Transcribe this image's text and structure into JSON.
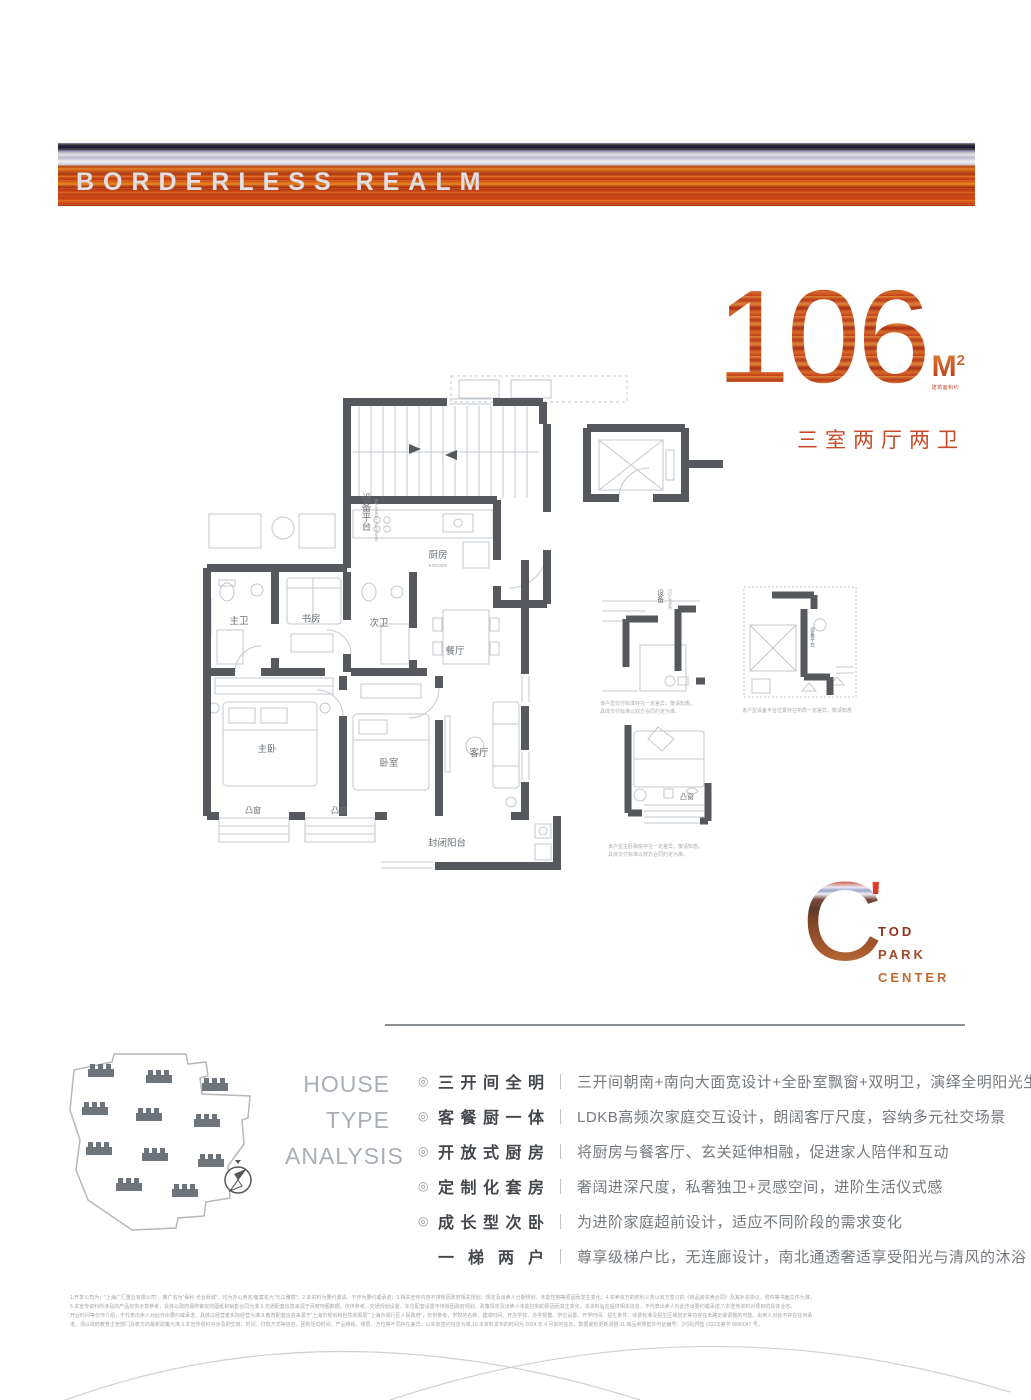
{
  "banner": {
    "title": "BORDERLESS REALM"
  },
  "headline": {
    "area_number": "106",
    "area_unit": "M",
    "area_sup": "2",
    "area_note": "建筑面积约",
    "layout": "三室两厅两卫"
  },
  "floorplan": {
    "rooms": {
      "equipment_platform": "设备平台",
      "equipment_platform_en": "EQUIPMENT PLATFORM",
      "kitchen": "厨房",
      "kitchen_en": "KITCHEN",
      "master_bath": "主卫",
      "study": "书房",
      "second_bath": "次卫",
      "dining": "餐厅",
      "master_bedroom": "主卧",
      "bedroom": "卧室",
      "living": "客厅",
      "bay_window_1": "凸窗",
      "bay_window_2": "凸窗",
      "balcony": "封闭阳台",
      "bay_window_detail": "凸窗",
      "equipment_detail": "设备",
      "equipment_detail_en": "EQUIPME",
      "equipment_detail_2": "设备平台"
    },
    "detail_captions": {
      "d1_line1": "该户型交付标准存在一定差异，敬请知悉。",
      "d1_line2": "具体交付标准以双方合同约定为准。",
      "d2_line1": "该户型设备平台位置存在布局一定差异，敬请知悉",
      "d3_line1": "该户型主卧飘窗存在一定差异，敬请知悉。",
      "d3_line2": "具体交付标准以双方合同约定为准。"
    }
  },
  "logo": {
    "mark": "C",
    "apostrophe": "'",
    "line1": "TOD",
    "line2": "PARK",
    "line3": "CENTER"
  },
  "analysis": {
    "heading1": "HOUSE",
    "heading2": "TYPE",
    "heading3": "ANALYSIS",
    "items": [
      {
        "icon": "◎",
        "title": "三开间全明",
        "separator": "｜",
        "desc": "三开间朝南+南向大面宽设计+全卧室飘窗+双明卫，演绎全明阳光生活"
      },
      {
        "icon": "◎",
        "title": "客餐厨一体",
        "separator": "｜",
        "desc": "LDKB高频次家庭交互设计，朗阔客厅尺度，容纳多元社交场景"
      },
      {
        "icon": "◎",
        "title": "开放式厨房",
        "separator": "｜",
        "desc": "将厨房与餐客厅、玄关延伸相融，促进家人陪伴和互动"
      },
      {
        "icon": "◎",
        "title": "定制化套房",
        "separator": "｜",
        "desc": "奢阔进深尺度，私奢独卫+灵感空间，进阶生活仪式感"
      },
      {
        "icon": "◎",
        "title": "成长型次卧",
        "separator": "｜",
        "desc": "为进阶家庭超前设计，适应不同阶段的需求变化"
      },
      {
        "icon": "",
        "title": "一梯两户",
        "separator": "｜",
        "desc": "尊享级梯户比，无连廊设计，南北通透奢适享受阳光与清风的沐浴"
      }
    ]
  },
  "disclaimer": {
    "line1": "1.开发公司为：“上海广汇置业有限公司”，推广名为“保利·光合跃城”，均为办公用名/备案名为“元江雅境”；2.本资料为要约邀请，不作为要约或承诺；3.相关宣传内容不排除因政府相关规划、规定及出卖人分期规划、未能控制等原因而发生变化；4.买卖双方的权利义务以双方签订的《商品房买卖合同》及其补充协议、附件等书面文件为准；",
    "line2": "5.本宣传资料所涉及的产品仅供示意参考，具体以政府最终审定的图纸和销售合同为准,6.交通配套信息来源于百度地图数据，仅供参考，交通规划设置、车位配套设置不排除因政府规划、政策规定及出卖人未能控制的原因而发生变化，本资料旨在提供相关信息，不代表出卖人对此作出要约或承诺,7.本宣传资料对项目的具体业态、",
    "line3": "开业时间等仅作介绍，不代表出卖人对此作出要约或承诺，具体以经营者实际经营为准,8.教育配套信息来源于“上海市规划和自然资源局”“上海市闵行区人民政府”，仅供参考，学校的名称、建成时间、开办学校、办学规模、学位设置、开学时间、招生条件、收费标准及招生区域划定等均存在未确定或调整的可能，出卖人对此不存在任何承",
    "line4": "诺，须以政府教育主管部门及校方的最新政策为准,9.本宣传资料中涉及的交房、时间、付款方式等信息，团购活动时间、产品楼栋、楼层、方位等不同存在差异，以实际签约信息为准,10.本资料发布的时间为 2024 年 4 月前的信息，数据或有更新调整,11.商品房预售许可证编号：沪(闵)预售 (2023)第字 0000047 号。"
  }
}
